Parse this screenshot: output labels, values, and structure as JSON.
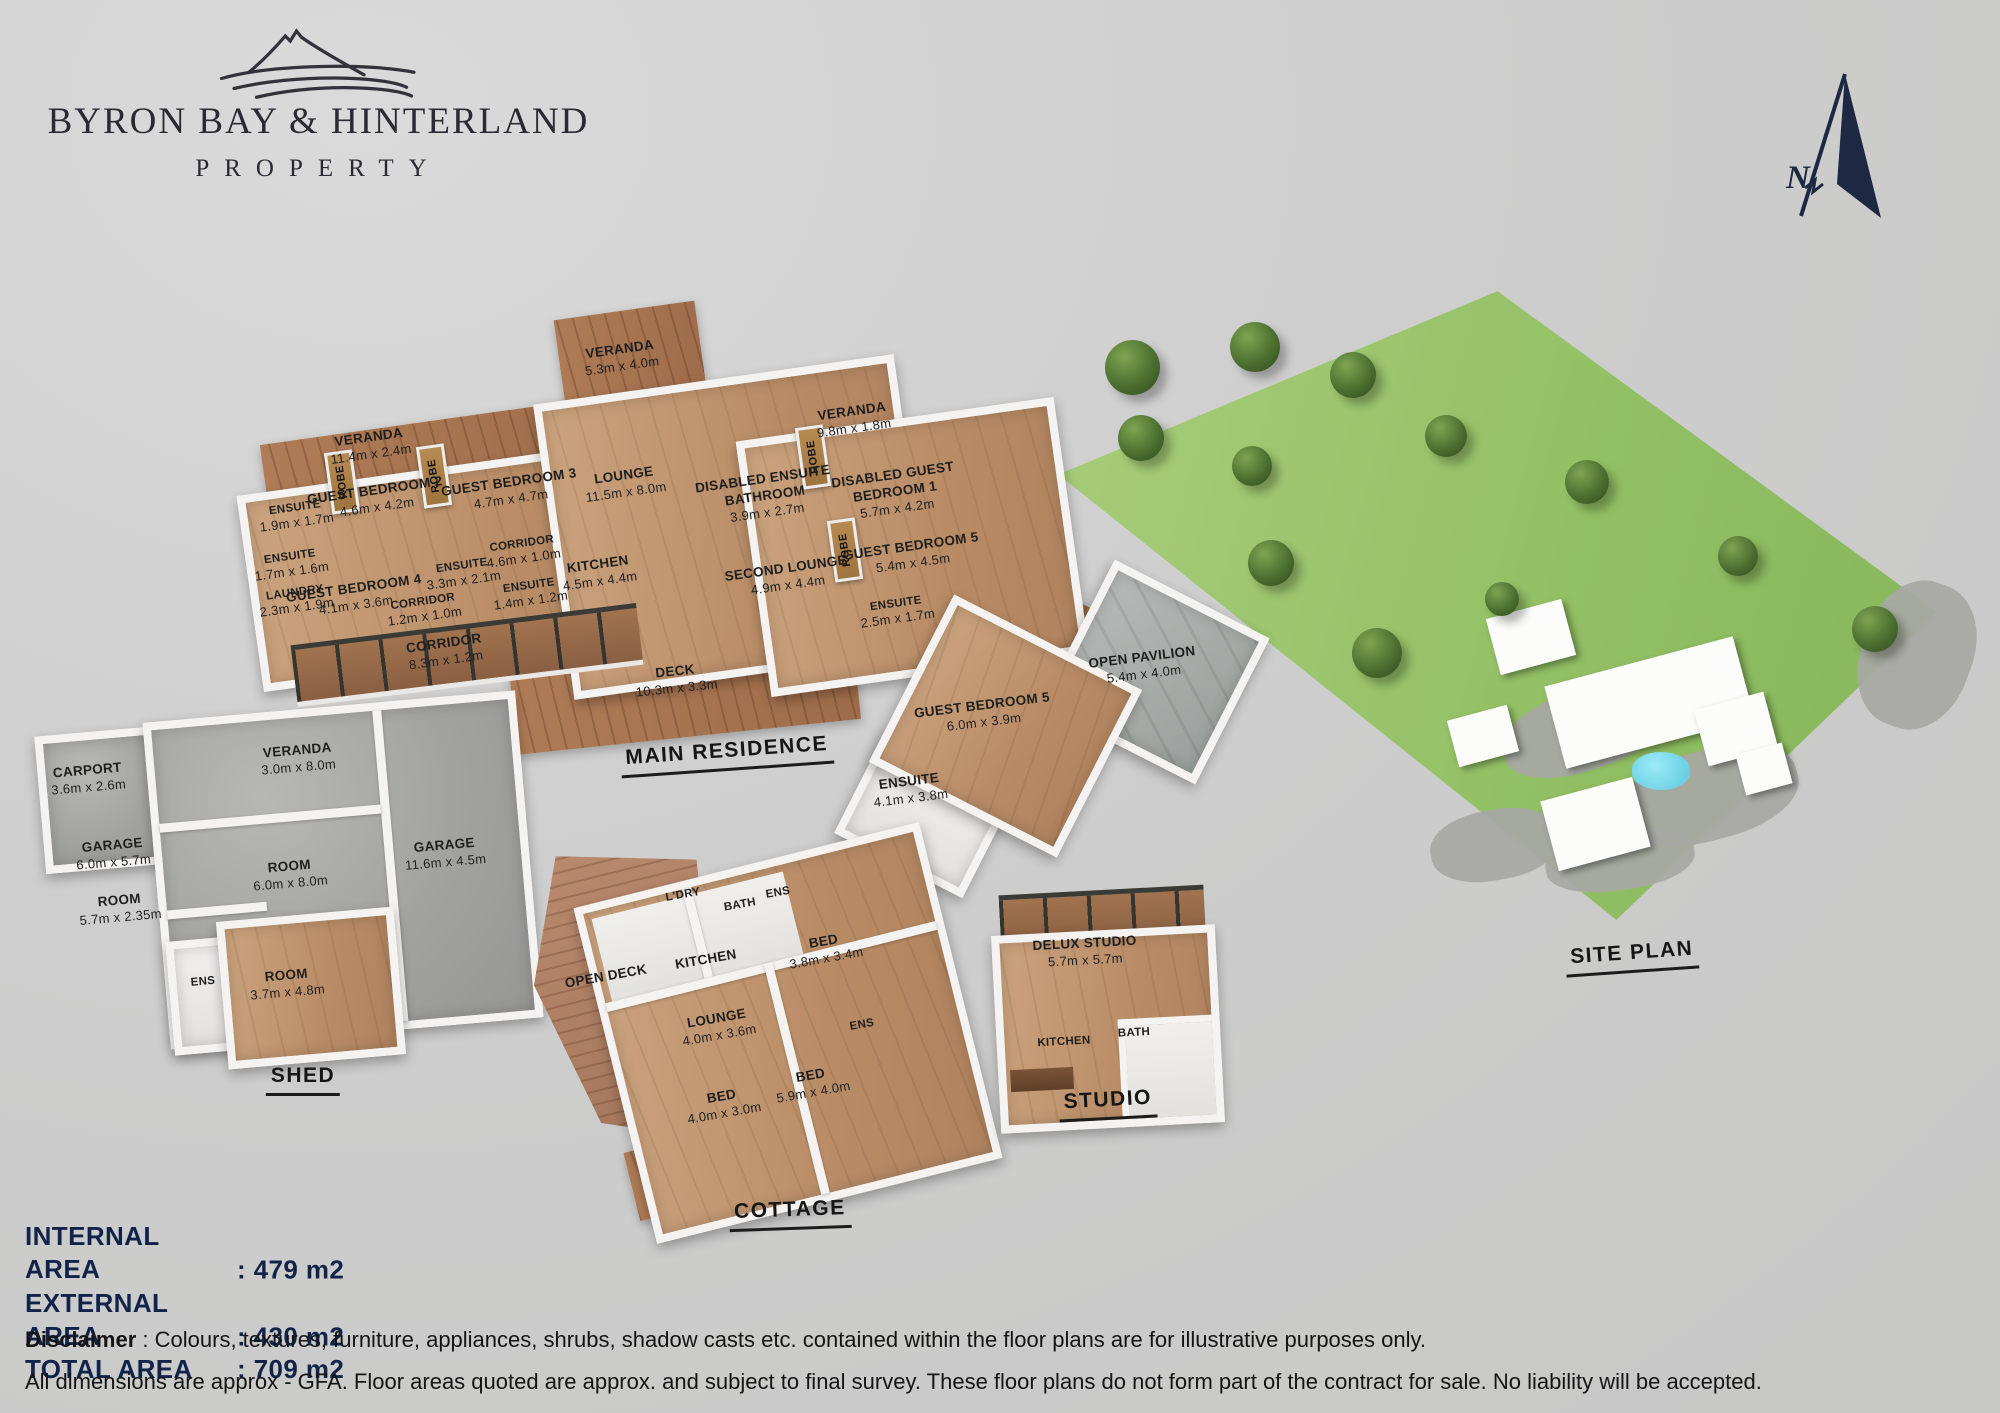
{
  "brand": {
    "line1": "BYRON BAY & HINTERLAND",
    "line2": "PROPERTY"
  },
  "compass": {
    "north_label": "N"
  },
  "buildings": {
    "main": {
      "title": "MAIN RESIDENCE",
      "robe_label": "ROBE",
      "rooms": {
        "veranda_top": {
          "name": "VERANDA",
          "dims": "5.3m x 4.0m"
        },
        "veranda_left": {
          "name": "VERANDA",
          "dims": "11.4m x 2.4m"
        },
        "ensuite_a": {
          "name": "ENSUITE",
          "dims": "1.9m x 1.7m"
        },
        "guest_bedroom_2": {
          "name": "GUEST BEDROOM 2",
          "dims": "4.6m x 4.2m"
        },
        "guest_bedroom_3": {
          "name": "GUEST BEDROOM 3",
          "dims": "4.7m x 4.7m"
        },
        "lounge": {
          "name": "LOUNGE",
          "dims": "11.5m x 8.0m"
        },
        "ensuite_b": {
          "name": "ENSUITE",
          "dims": "1.7m x 1.6m"
        },
        "laundry": {
          "name": "LAUNDRY",
          "dims": "2.3m x 1.9m"
        },
        "guest_bedroom_4": {
          "name": "GUEST BEDROOM 4",
          "dims": "4.1m x 3.6m"
        },
        "corridor_a": {
          "name": "CORRIDOR",
          "dims": "4.6m x 1.0m"
        },
        "ensuite_c": {
          "name": "ENSUITE",
          "dims": "3.3m x 2.1m"
        },
        "ensuite_d": {
          "name": "ENSUITE",
          "dims": "1.4m x 1.2m"
        },
        "corridor_b": {
          "name": "CORRIDOR",
          "dims": "1.2m x 1.0m"
        },
        "corridor_c": {
          "name": "CORRIDOR",
          "dims": "8.3m x 1.2m"
        },
        "kitchen": {
          "name": "KITCHEN",
          "dims": "4.5m x 4.4m"
        },
        "deck": {
          "name": "DECK",
          "dims": "10.3m x 3.3m"
        },
        "disabled_ensuite_bathroom": {
          "name": "DISABLED ENSUITE BATHROOM",
          "dims": "3.9m x 2.7m"
        },
        "veranda_right": {
          "name": "VERANDA",
          "dims": "9.8m x 1.8m"
        },
        "disabled_guest_bedroom_1": {
          "name": "DISABLED GUEST BEDROOM 1",
          "dims": "5.7m x 4.2m"
        },
        "second_lounge": {
          "name": "SECOND LOUNGE",
          "dims": "4.9m x 4.4m"
        },
        "guest_bedroom_5": {
          "name": "GUEST BEDROOM 5",
          "dims": "5.4m x 4.5m"
        },
        "ensuite_e": {
          "name": "ENSUITE",
          "dims": "2.5m x 1.7m"
        }
      }
    },
    "guest_wing": {
      "rooms": {
        "guest_bedroom_5": {
          "name": "GUEST BEDROOM 5",
          "dims": "6.0m x 3.9m"
        },
        "ensuite": {
          "name": "ENSUITE",
          "dims": "4.1m x 3.8m"
        },
        "open_pavilion": {
          "name": "OPEN PAVILION",
          "dims": "5.4m x 4.0m"
        }
      }
    },
    "shed": {
      "title": "SHED",
      "rooms": {
        "carport": {
          "name": "CARPORT",
          "dims": "3.6m x 2.6m"
        },
        "veranda": {
          "name": "VERANDA",
          "dims": "3.0m x 8.0m"
        },
        "garage_a": {
          "name": "GARAGE",
          "dims": "6.0m x 5.7m"
        },
        "room_a": {
          "name": "ROOM",
          "dims": "5.7m x 2.35m"
        },
        "room_b": {
          "name": "ROOM",
          "dims": "6.0m x 8.0m"
        },
        "garage_b": {
          "name": "GARAGE",
          "dims": "11.6m x 4.5m"
        },
        "ens": {
          "name": "ENS"
        },
        "room_c": {
          "name": "ROOM",
          "dims": "3.7m x 4.8m"
        }
      }
    },
    "cottage": {
      "title": "COTTAGE",
      "rooms": {
        "open_deck": {
          "name": "OPEN DECK"
        },
        "ldry": {
          "name": "L'DRY"
        },
        "bath": {
          "name": "BATH"
        },
        "ens_a": {
          "name": "ENS"
        },
        "kitchen": {
          "name": "KITCHEN"
        },
        "bed_a": {
          "name": "BED",
          "dims": "3.8m x 3.4m"
        },
        "lounge": {
          "name": "LOUNGE",
          "dims": "4.0m x 3.6m"
        },
        "ens_b": {
          "name": "ENS"
        },
        "bed_b": {
          "name": "BED",
          "dims": "5.9m x 4.0m"
        },
        "bed_c": {
          "name": "BED",
          "dims": "4.0m x 3.0m"
        }
      }
    },
    "studio": {
      "title": "STUDIO",
      "rooms": {
        "delux_studio": {
          "name": "DELUX STUDIO",
          "dims": "5.7m x 5.7m"
        },
        "kitchen": {
          "name": "KITCHEN"
        },
        "bath": {
          "name": "BATH"
        }
      }
    },
    "site": {
      "title": "SITE PLAN"
    }
  },
  "areas": {
    "rows": [
      {
        "label": "INTERNAL AREA",
        "value": ": 479 m2"
      },
      {
        "label": "EXTERNAL AREA",
        "value": ": 430 m2"
      },
      {
        "label": "TOTAL AREA",
        "value": ": 709 m2"
      }
    ]
  },
  "disclaimer": {
    "bold": "Disclaimer",
    "line1_rest": " : Colours, textures, furniture, appliances, shrubs, shadow casts etc. contained within the floor plans are for illustrative  purposes only.",
    "line2": "All dimensions are approx - GFA. Floor areas quoted are approx. and  subject to final survey. These floor plans do not form part of the contract for sale. No liability will be accepted."
  },
  "colors": {
    "background": "#cecece",
    "area_text": "#12234a",
    "floor_wood": "#c29874",
    "deck_wood": "#a5714f",
    "concrete": "#a3a3a3",
    "site_green": "#93c065",
    "pool_blue": "#7adced",
    "wall_white": "#f4f3f1",
    "logo_ink": "#2b2a33"
  }
}
